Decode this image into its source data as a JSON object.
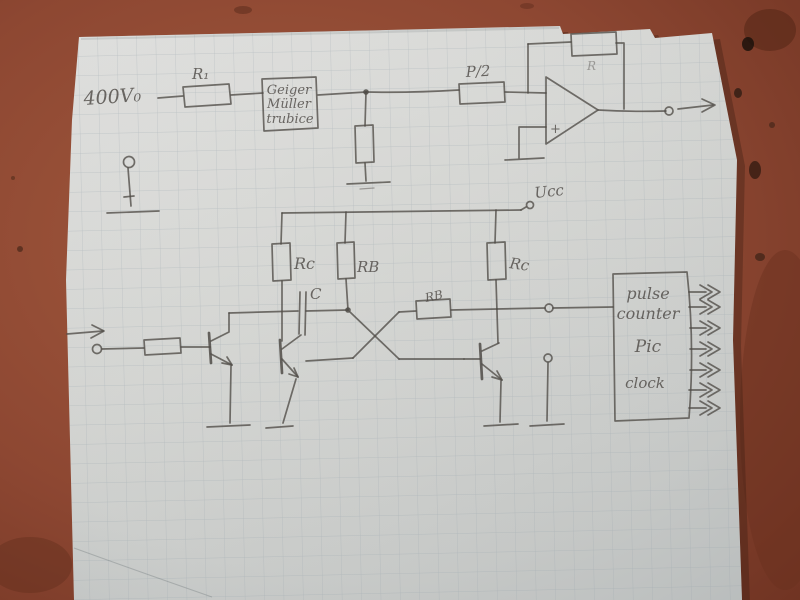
{
  "colors": {
    "table": "#8d4732",
    "paper": "#d6d6d3",
    "grid_line": "#9aa6ac",
    "pencil": "#4f4b47"
  },
  "schematic": {
    "hv_label": "400V₀",
    "r1_label": "R₁",
    "geiger_box": {
      "line1": "Geiger",
      "line2": "Müller",
      "line3": "trubice"
    },
    "p2_label": "P/2",
    "feedback_resistor_label": "R",
    "opamp_plus_label": "+",
    "ucc_label": "Ucc",
    "rc_left_label": "Rc",
    "rb_mid_label": "RB",
    "capacitor_label": "C",
    "rb_horizontal_label": "RB",
    "rc_right_label": "Rc",
    "counter_box": {
      "line1": "pulse",
      "line2": "counter",
      "line3": "Pic",
      "line4": "clock"
    }
  }
}
